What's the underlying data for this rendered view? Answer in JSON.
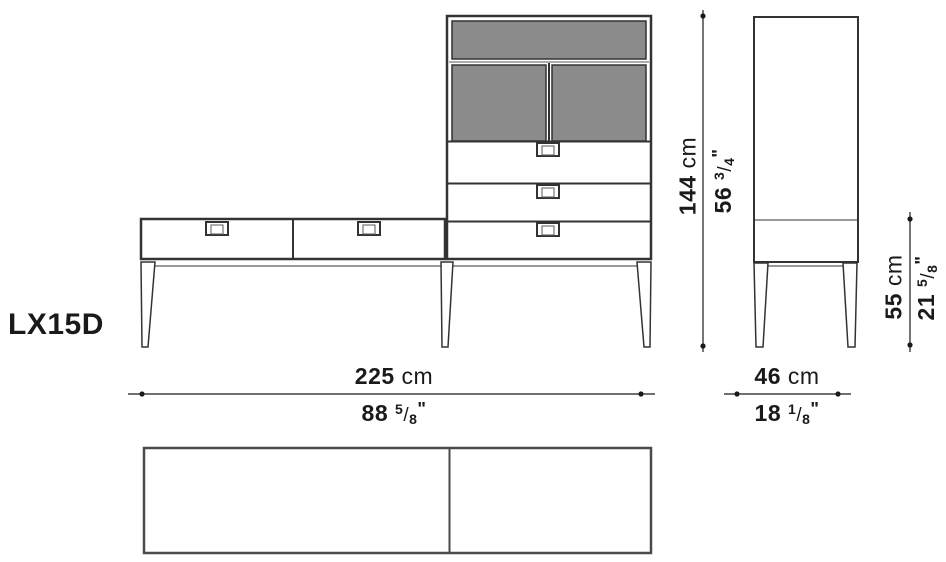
{
  "product": {
    "code": "LX15D"
  },
  "dimensions": {
    "total_width": {
      "cm": "225",
      "unit": "cm",
      "inches": "88",
      "frac_num": "5",
      "frac_den": "8",
      "inch_mark": "\""
    },
    "depth": {
      "cm": "46",
      "unit": "cm",
      "inches": "18",
      "frac_num": "1",
      "frac_den": "8",
      "inch_mark": "\""
    },
    "tall_height": {
      "cm": "144",
      "unit": "cm",
      "inches": "56",
      "frac_num": "3",
      "frac_den": "4",
      "inch_mark": "\""
    },
    "low_height": {
      "cm": "55",
      "unit": "cm",
      "inches": "21",
      "frac_num": "5",
      "frac_den": "8",
      "inch_mark": "\""
    }
  },
  "colors": {
    "line": "#333333",
    "line_light": "#5a5a5a",
    "panel_gray": "#8b8b8b",
    "text": "#1a1a1a",
    "background": "#ffffff"
  }
}
